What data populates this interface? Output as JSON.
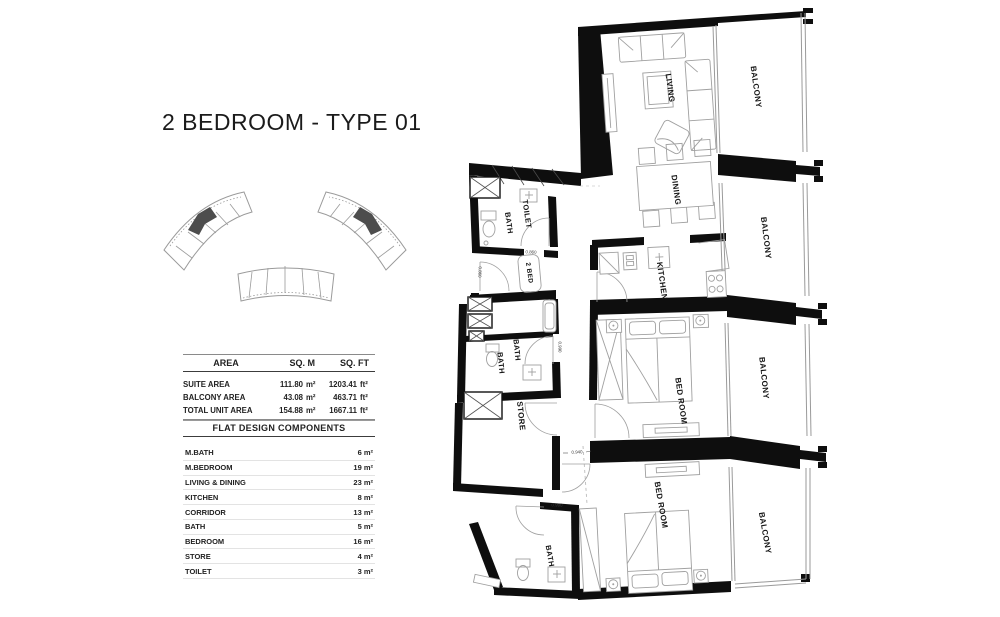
{
  "title": "2 BEDROOM - TYPE 01",
  "key_plan": {
    "description": "site key plan: three curved residential blocks",
    "highlight_color": "#4d4d4d",
    "highlighted_blocks": [
      "top-left",
      "top-right"
    ]
  },
  "area_table": {
    "headers": [
      "AREA",
      "SQ. M",
      "SQ. FT"
    ],
    "rows": [
      {
        "name": "SUITE AREA",
        "sqm": "111.80",
        "sqm_unit": "m²",
        "sqft": "1203.41",
        "sqft_unit": "ft²"
      },
      {
        "name": "BALCONY AREA",
        "sqm": "43.08",
        "sqm_unit": "m²",
        "sqft": "463.71",
        "sqft_unit": "ft²"
      },
      {
        "name": "TOTAL UNIT AREA",
        "sqm": "154.88",
        "sqm_unit": "m²",
        "sqft": "1667.11",
        "sqft_unit": "ft²"
      }
    ]
  },
  "components_table": {
    "title": "FLAT DESIGN COMPONENTS",
    "rows": [
      {
        "name": "M.BATH",
        "value": "6 m²"
      },
      {
        "name": "M.BEDROOM",
        "value": "19 m²"
      },
      {
        "name": "LIVING & DINING",
        "value": "23 m²"
      },
      {
        "name": "KITCHEN",
        "value": "8 m²"
      },
      {
        "name": "CORRIDOR",
        "value": "13 m²"
      },
      {
        "name": "BATH",
        "value": "5 m²"
      },
      {
        "name": "BEDROOM",
        "value": "16 m²"
      },
      {
        "name": "STORE",
        "value": "4 m²"
      },
      {
        "name": "TOILET",
        "value": "3 m²"
      }
    ]
  },
  "floorplan": {
    "rooms": [
      {
        "name": "living",
        "text": "LIVING"
      },
      {
        "name": "balcony-1",
        "text": "BALCONY"
      },
      {
        "name": "dining",
        "text": "DINING"
      },
      {
        "name": "toilet",
        "text": "TOILET"
      },
      {
        "name": "bath-1",
        "text": "BATH"
      },
      {
        "name": "entry",
        "text": "2 BED"
      },
      {
        "name": "kitchen",
        "text": "KITCHEN"
      },
      {
        "name": "balcony-2",
        "text": "BALCONY"
      },
      {
        "name": "bath-2",
        "text": "BATH"
      },
      {
        "name": "bath-3",
        "text": "BATH"
      },
      {
        "name": "store",
        "text": "STORE"
      },
      {
        "name": "bedroom-1",
        "text": "BED ROOM"
      },
      {
        "name": "balcony-3",
        "text": "BALCONY"
      },
      {
        "name": "bedroom-2",
        "text": "BED ROOM"
      },
      {
        "name": "bath-4",
        "text": "BATH"
      },
      {
        "name": "balcony-4",
        "text": "BALCONY"
      }
    ],
    "dimensions": [
      {
        "text": "0.860"
      },
      {
        "text": "0.940"
      },
      {
        "text": "0.990"
      },
      {
        "text": "0.990"
      },
      {
        "text": "0.860"
      }
    ],
    "colors": {
      "wall": "#0e0e0e",
      "line": "#9a9a9a"
    }
  }
}
